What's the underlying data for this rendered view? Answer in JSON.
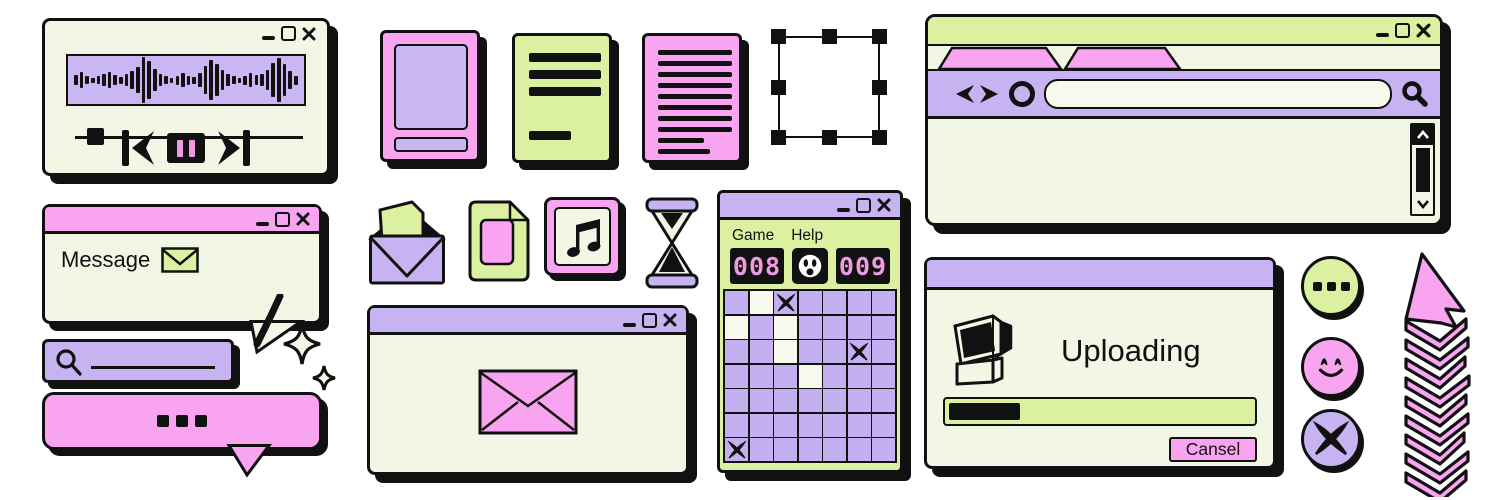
{
  "colors": {
    "pink": "#f8a4f0",
    "purple": "#c7b3f2",
    "green": "#dcf0a1",
    "cream": "#f2f6e5",
    "ink": "#111111",
    "lcd_pink": "#f09ae4"
  },
  "audio_player": {
    "waveform_bars": [
      10,
      16,
      8,
      5,
      8,
      12,
      16,
      10,
      7,
      12,
      18,
      26,
      46,
      38,
      22,
      12,
      8,
      5,
      9,
      14,
      9,
      7,
      14,
      28,
      40,
      32,
      20,
      12,
      8,
      5,
      9,
      14,
      10,
      12,
      20,
      34,
      44,
      32,
      18,
      9
    ]
  },
  "browser": {
    "tab_count": 2,
    "address_value": ""
  },
  "message_window": {
    "title": "Message"
  },
  "minesweeper": {
    "menu": [
      {
        "label": "Game"
      },
      {
        "label": "Help"
      }
    ],
    "mine_counter": "008",
    "timer": "009",
    "grid": {
      "rows": 7,
      "cols": 7,
      "revealed_cells": [
        [
          0,
          1
        ],
        [
          1,
          0
        ],
        [
          1,
          2
        ],
        [
          2,
          2
        ],
        [
          3,
          3
        ]
      ],
      "mine_cells": [
        [
          0,
          2
        ],
        [
          2,
          5
        ],
        [
          6,
          0
        ]
      ]
    }
  },
  "upload_dialog": {
    "title": "Uploading",
    "progress_percent": 23,
    "cancel_label": "Cansel"
  }
}
